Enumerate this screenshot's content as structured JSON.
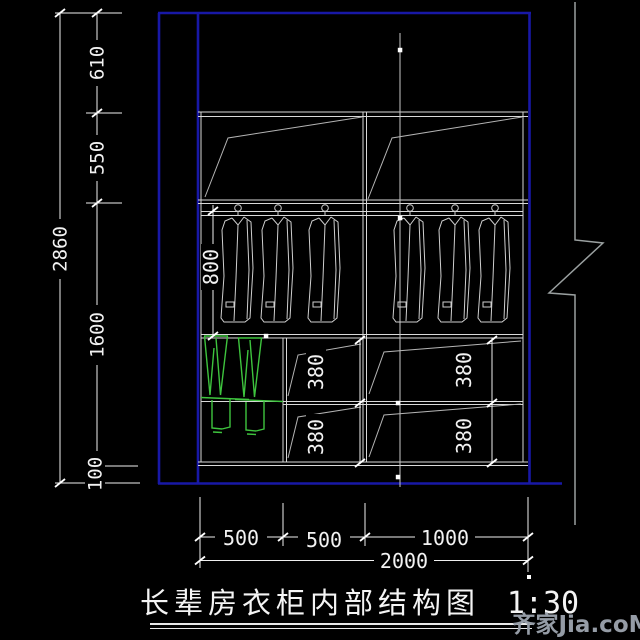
{
  "drawing": {
    "title": "长辈房衣柜内部结构图",
    "scale_label": "1:30",
    "watermark": "齐家Jia.coM"
  },
  "dimensions": {
    "overall_height": "2860",
    "height_segments": {
      "top": "610",
      "upper": "550",
      "middle": "1600",
      "base": "100"
    },
    "hanging_depth": "800",
    "left_drawer_heights": [
      "380",
      "380"
    ],
    "right_drawer_heights": [
      "380",
      "380"
    ],
    "bottom_segments": [
      "500",
      "500",
      "1000"
    ],
    "overall_width": "2000"
  },
  "colors": {
    "frame_blue": "#1818a6",
    "clothes_green": "#3ec43e",
    "line_white": "#d9d9d9"
  }
}
